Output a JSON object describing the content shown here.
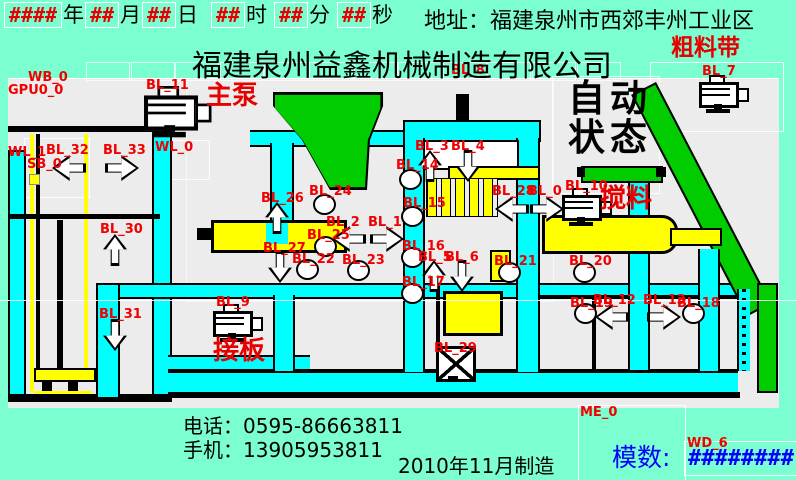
{
  "header": {
    "date_parts": [
      {
        "value": "####",
        "unit": "年"
      },
      {
        "value": "##",
        "unit": "月"
      },
      {
        "value": "##",
        "unit": "日"
      },
      {
        "value": "##",
        "unit": "时"
      },
      {
        "value": "##",
        "unit": "分"
      },
      {
        "value": "##",
        "unit": "秒"
      }
    ],
    "address": "地址：福建泉州市西郊丰州工业区",
    "company": "福建泉州益鑫机械制造有限公司"
  },
  "status": {
    "line1": "自动",
    "line2": "状态"
  },
  "annotations": [
    {
      "text": "主泵",
      "x": 206,
      "y": 83,
      "size": 26
    },
    {
      "text": "粗料带",
      "x": 671,
      "y": 36,
      "size": 23
    },
    {
      "text": "搅料",
      "x": 600,
      "y": 186,
      "size": 26
    },
    {
      "text": "接板",
      "x": 213,
      "y": 338,
      "size": 26
    }
  ],
  "tags": [
    {
      "label": "GPU0_0",
      "kind": "none",
      "x": 8,
      "y": 84
    },
    {
      "label": "WB_0",
      "kind": "none",
      "x": 28,
      "y": 71
    },
    {
      "label": "BL_11",
      "kind": "pump",
      "x": 146,
      "y": 79,
      "ix": 144,
      "iy": 86
    },
    {
      "label": "BL_8",
      "kind": "none",
      "x": 451,
      "y": 64
    },
    {
      "label": "BL_7",
      "kind": "motor",
      "x": 702,
      "y": 65,
      "ix": 699,
      "iy": 75
    },
    {
      "label": "WL_1",
      "kind": "none",
      "x": 8,
      "y": 146
    },
    {
      "label": "BL_32",
      "kind": "arrow-left",
      "x": 46,
      "y": 144,
      "ix": 52,
      "iy": 155
    },
    {
      "label": "BL_33",
      "kind": "arrow-right",
      "x": 103,
      "y": 144,
      "ix": 105,
      "iy": 155
    },
    {
      "label": "WL_0",
      "kind": "none",
      "x": 155,
      "y": 141
    },
    {
      "label": "SB_0",
      "kind": "square",
      "x": 27,
      "y": 158,
      "ix": 29,
      "iy": 174
    },
    {
      "label": "BL_3",
      "kind": "arrow-up",
      "x": 415,
      "y": 140,
      "ix": 418,
      "iy": 150
    },
    {
      "label": "BL_4",
      "kind": "arrow-down",
      "x": 451,
      "y": 140,
      "ix": 456,
      "iy": 150
    },
    {
      "label": "BL_14",
      "kind": "circle",
      "x": 396,
      "y": 159,
      "ix": 399,
      "iy": 169
    },
    {
      "label": "BL_26",
      "kind": "arrow-up",
      "x": 261,
      "y": 192,
      "ix": 265,
      "iy": 202
    },
    {
      "label": "BL_24",
      "kind": "circle",
      "x": 309,
      "y": 185,
      "ix": 313,
      "iy": 194
    },
    {
      "label": "BL_15",
      "kind": "circle",
      "x": 403,
      "y": 197,
      "ix": 401,
      "iy": 206
    },
    {
      "label": "BL_28",
      "kind": "arrow-left",
      "x": 492,
      "y": 185,
      "ix": 495,
      "iy": 196
    },
    {
      "label": "BL_0",
      "kind": "arrow-right",
      "x": 528,
      "y": 185,
      "ix": 530,
      "iy": 196
    },
    {
      "label": "BL_10",
      "kind": "motor",
      "x": 565,
      "y": 180,
      "ix": 562,
      "iy": 188
    },
    {
      "label": "BL_2",
      "kind": "arrow-left",
      "x": 326,
      "y": 216,
      "ix": 332,
      "iy": 226
    },
    {
      "label": "BL_1",
      "kind": "arrow-right",
      "x": 368,
      "y": 216,
      "ix": 370,
      "iy": 226
    },
    {
      "label": "BL_25",
      "kind": "circle",
      "x": 307,
      "y": 229,
      "ix": 314,
      "iy": 236
    },
    {
      "label": "BL_27",
      "kind": "arrow-down",
      "x": 263,
      "y": 242,
      "ix": 268,
      "iy": 251
    },
    {
      "label": "BL_22",
      "kind": "circle",
      "x": 292,
      "y": 253,
      "ix": 296,
      "iy": 259
    },
    {
      "label": "BL_23",
      "kind": "circle",
      "x": 342,
      "y": 254,
      "ix": 347,
      "iy": 260
    },
    {
      "label": "BL_16",
      "kind": "circle",
      "x": 402,
      "y": 240,
      "ix": 401,
      "iy": 247
    },
    {
      "label": "BL_5",
      "kind": "arrow-up",
      "x": 418,
      "y": 251,
      "ix": 422,
      "iy": 260
    },
    {
      "label": "BL_6",
      "kind": "arrow-down",
      "x": 445,
      "y": 251,
      "ix": 450,
      "iy": 260
    },
    {
      "label": "BL_17",
      "kind": "circle",
      "x": 402,
      "y": 276,
      "ix": 401,
      "iy": 283
    },
    {
      "label": "BL_21",
      "kind": "circle",
      "x": 494,
      "y": 255,
      "ix": 498,
      "iy": 262
    },
    {
      "label": "BL_20",
      "kind": "circle",
      "x": 569,
      "y": 255,
      "ix": 573,
      "iy": 262
    },
    {
      "label": "BL_30",
      "kind": "arrow-up",
      "x": 100,
      "y": 223,
      "ix": 103,
      "iy": 234
    },
    {
      "label": "BL_31",
      "kind": "arrow-down",
      "x": 99,
      "y": 308,
      "ix": 103,
      "iy": 319
    },
    {
      "label": "BL_9",
      "kind": "motor",
      "x": 216,
      "y": 296,
      "ix": 213,
      "iy": 304
    },
    {
      "label": "BL_29",
      "kind": "xbox",
      "x": 434,
      "y": 342,
      "ix": 436,
      "iy": 346
    },
    {
      "label": "BL_19",
      "kind": "circle",
      "x": 570,
      "y": 297,
      "ix": 574,
      "iy": 303
    },
    {
      "label": "BL_12",
      "kind": "arrow-left",
      "x": 593,
      "y": 294,
      "ix": 595,
      "iy": 304
    },
    {
      "label": "BL_13",
      "kind": "arrow-right",
      "x": 643,
      "y": 294,
      "ix": 647,
      "iy": 304
    },
    {
      "label": "BL_18",
      "kind": "circle",
      "x": 677,
      "y": 297,
      "ix": 682,
      "iy": 303
    },
    {
      "label": "ME_0",
      "kind": "none",
      "x": 580,
      "y": 406
    },
    {
      "label": "WD_6",
      "kind": "none",
      "x": 687,
      "y": 437
    }
  ],
  "module": {
    "label": "模数:",
    "value": "########"
  },
  "footer": {
    "phone_label": "电话：",
    "phone": "0595-86663811",
    "mobile_label": "手机：",
    "mobile": "13905953811",
    "manufactured": "2010年11月制造"
  },
  "colors": {
    "background": "#7CFFD0",
    "panel": "#ECECEC",
    "pipe": "#00FFFF",
    "belt": "#00CC00",
    "machine_yellow": "#FFFF00",
    "tag_red": "#F00000",
    "value_blue": "#0000FF"
  }
}
